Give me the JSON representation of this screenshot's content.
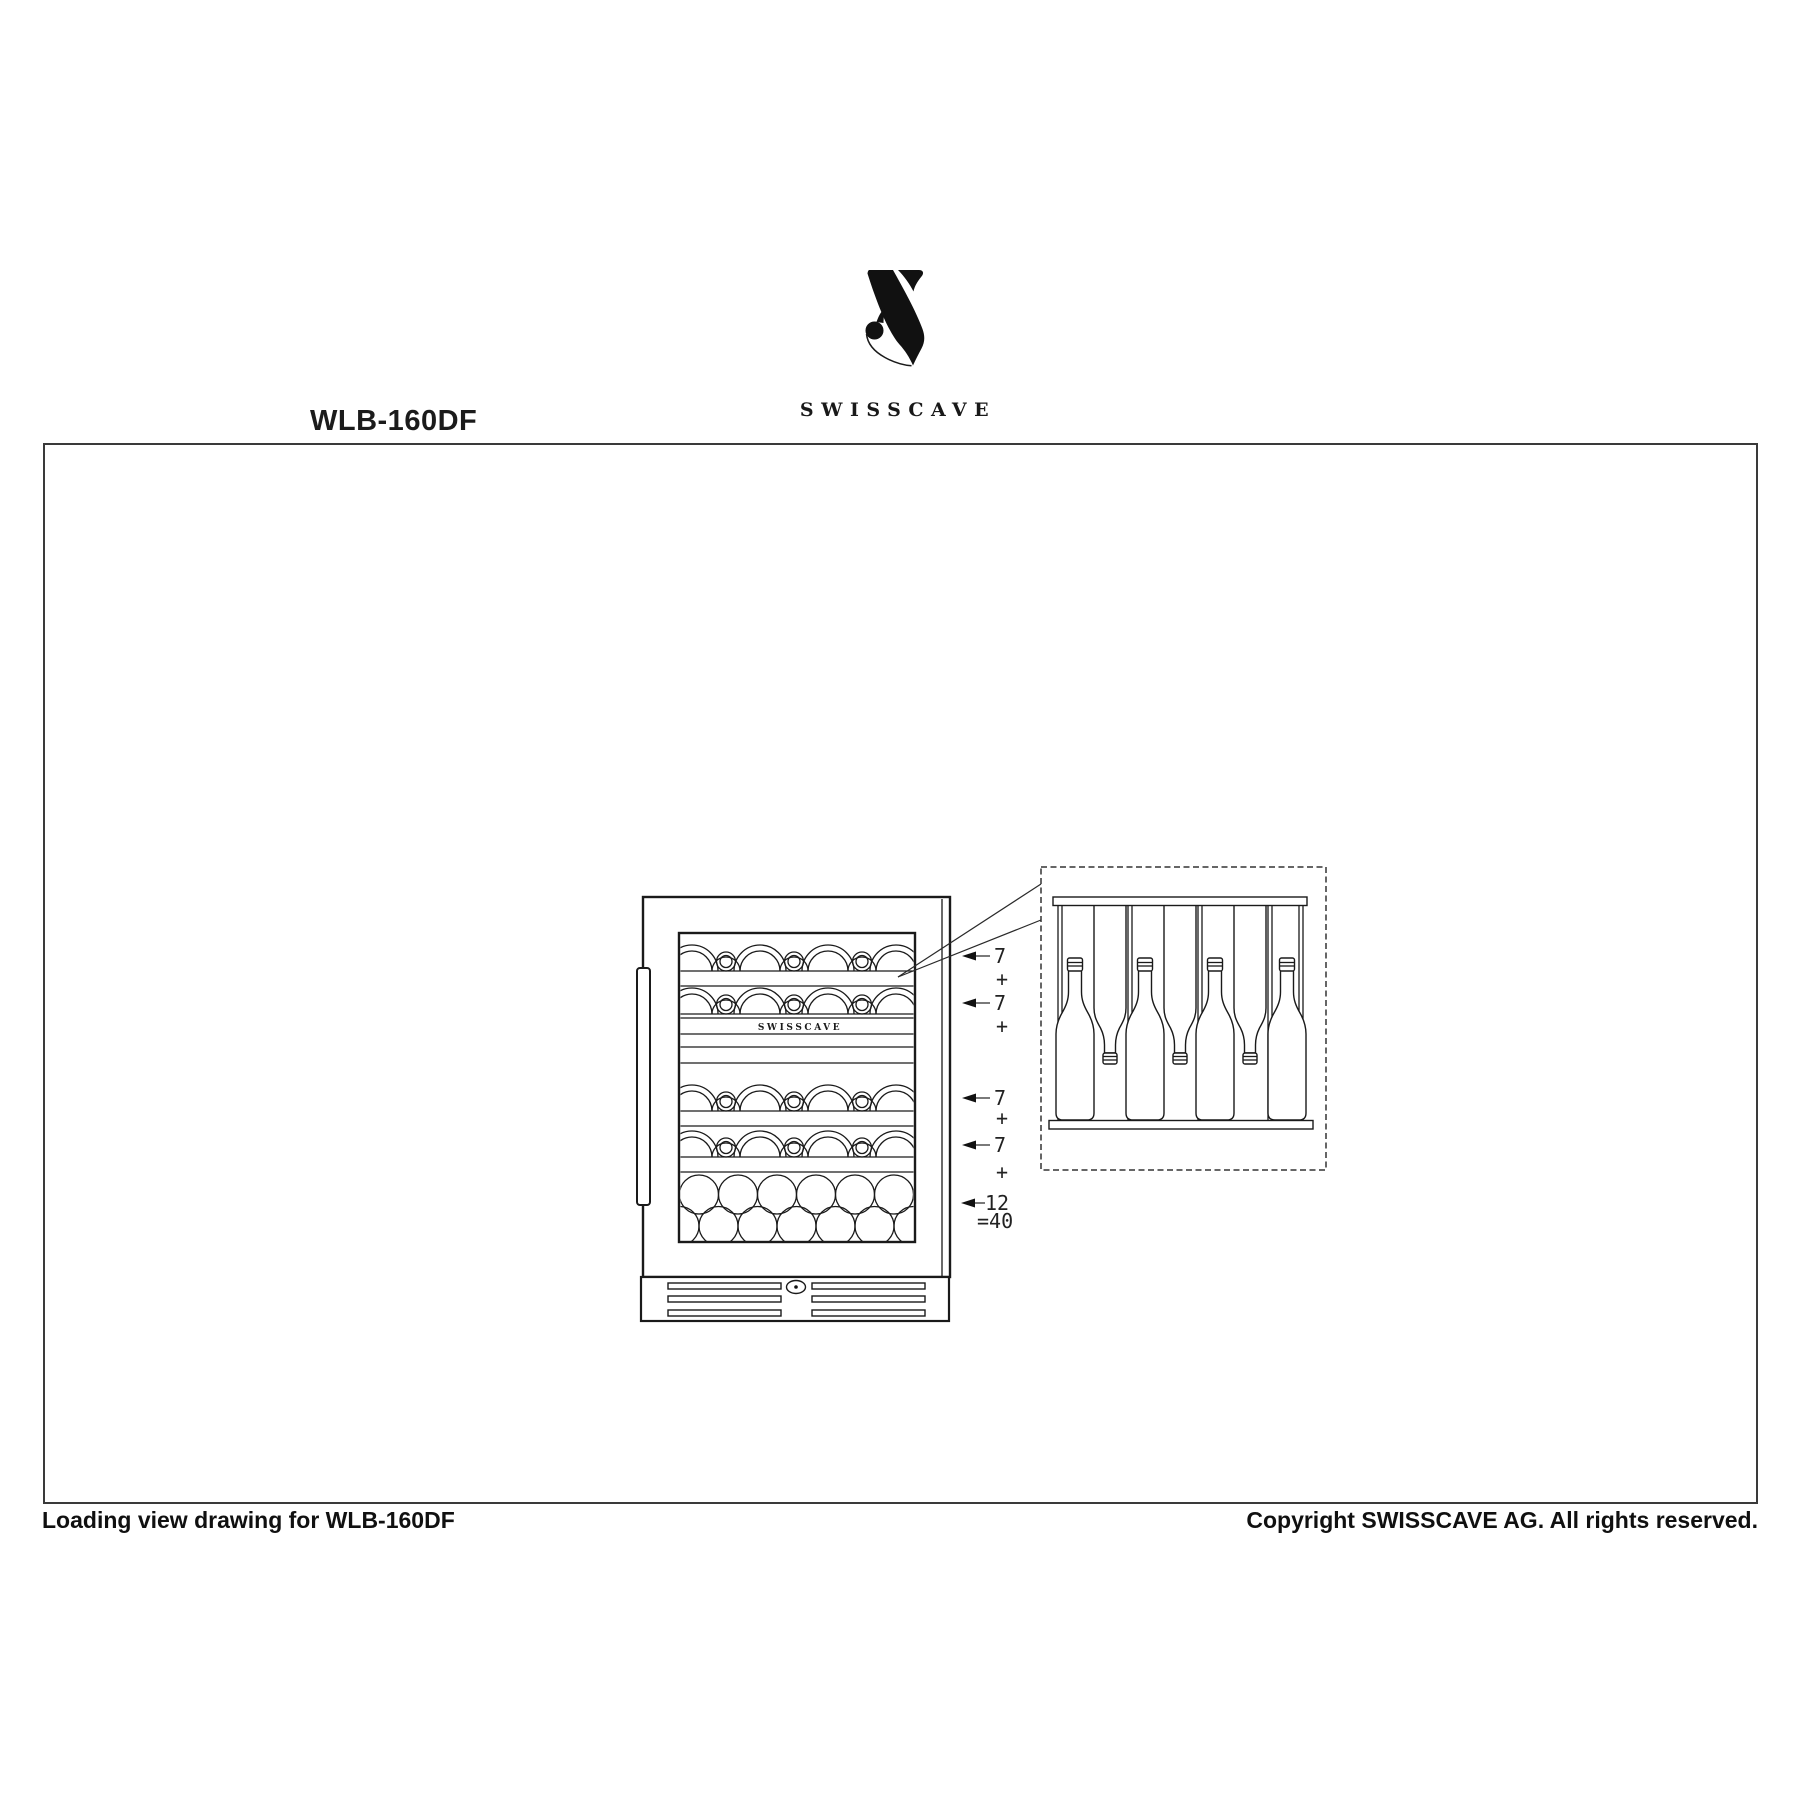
{
  "header": {
    "model_label": "WLB-160DF",
    "brand_name": "SWISSCAVE"
  },
  "drawing": {
    "door_brand_label": "SWISSCAVE",
    "capacity": {
      "row_counts": [
        "7",
        "7",
        "7",
        "7",
        "12"
      ],
      "plus_sign": "+",
      "total_label": "=40"
    }
  },
  "footer": {
    "left_text": "Loading view drawing for WLB-160DF",
    "right_text": "Copyright SWISSCAVE AG. All rights reserved."
  }
}
